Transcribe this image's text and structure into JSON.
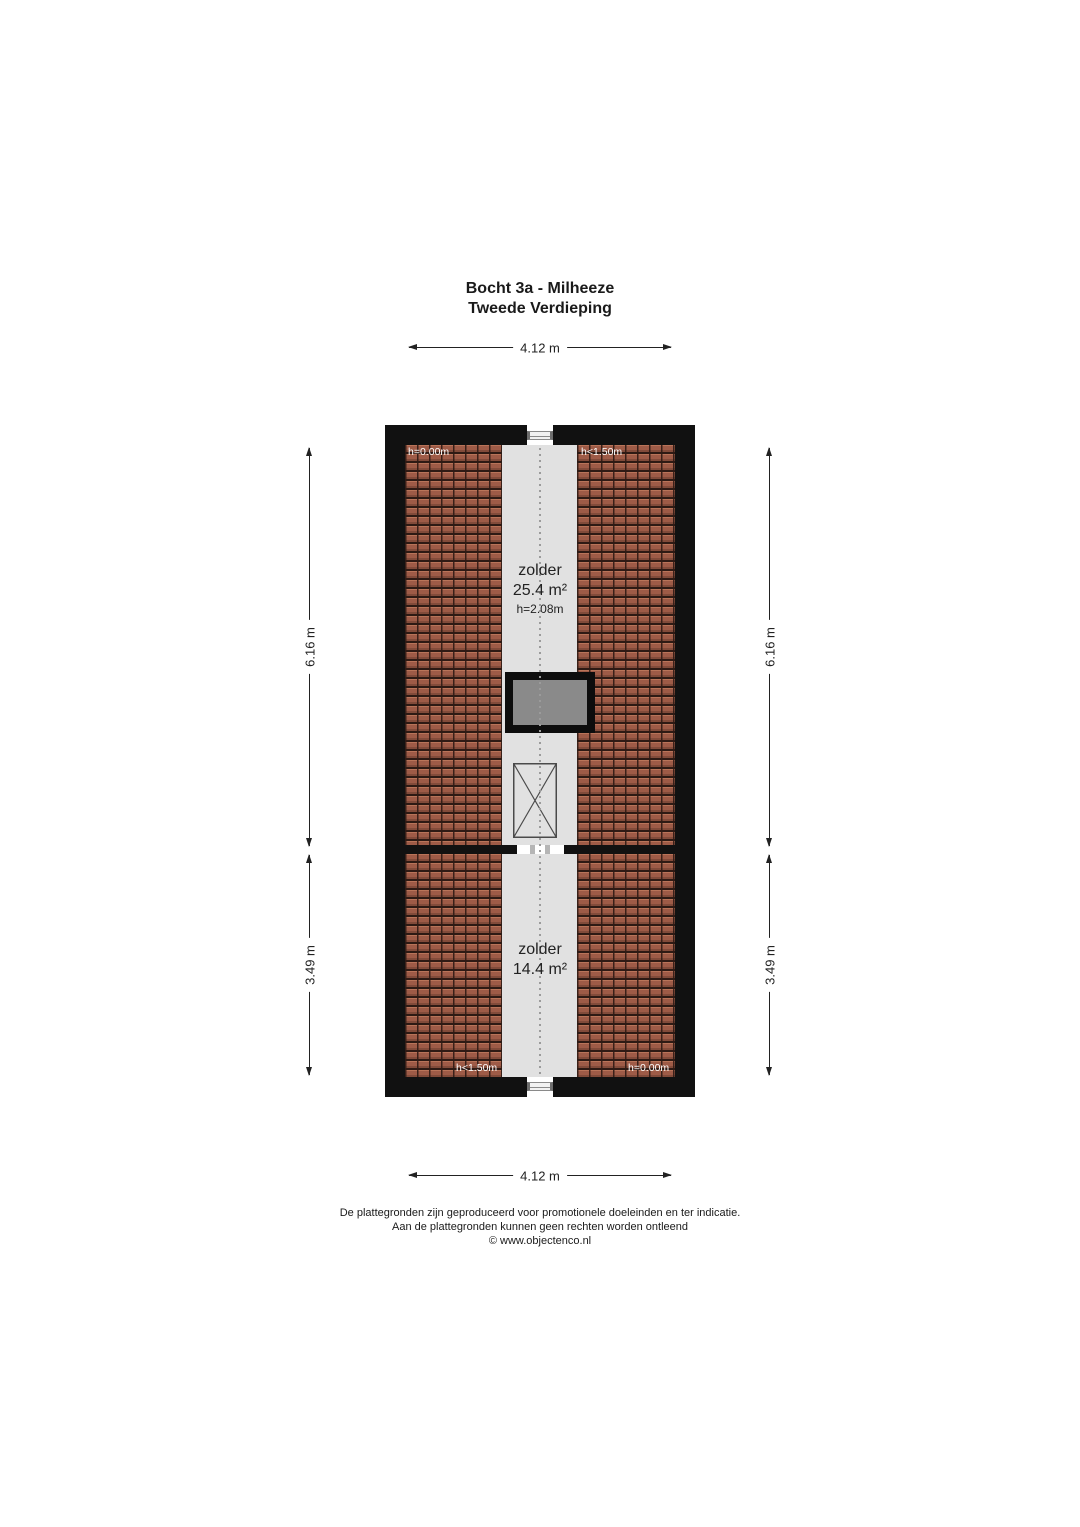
{
  "title": {
    "line1": "Bocht 3a - Milheeze",
    "line2": "Tweede Verdieping"
  },
  "dimensions": {
    "top_width": "4.12 m",
    "bottom_width": "4.12 m",
    "left_upper_height": "6.16 m",
    "left_lower_height": "3.49 m",
    "right_upper_height": "6.16 m",
    "right_lower_height": "3.49 m"
  },
  "floor_plan": {
    "upper_room": {
      "name": "zolder",
      "area": "25.4 m²",
      "ceiling_height": "h=2.08m"
    },
    "lower_room": {
      "name": "zolder",
      "area": "14.4 m²"
    },
    "height_annotations": {
      "top_left": "h=0.00m",
      "top_right": "h<1.50m",
      "bottom_left": "h<1.50m",
      "bottom_right": "h=0.00m"
    }
  },
  "footer": {
    "line1": "De plattegronden zijn geproduceerd voor promotionele doeleinden en ter indicatie.",
    "line2": "Aan de plattegronden kunnen geen rechten worden ontleend",
    "line3": "© www.objectenco.nl"
  },
  "colors": {
    "wall": "#111111",
    "floor": "#e1e1e1",
    "roof_tile": "#9e5b47",
    "roof_tile_seam": "#2e1a14",
    "chimney_fill": "#8a8a8a",
    "annotation_text": "#ffffff",
    "dimension_line": "#222222"
  }
}
